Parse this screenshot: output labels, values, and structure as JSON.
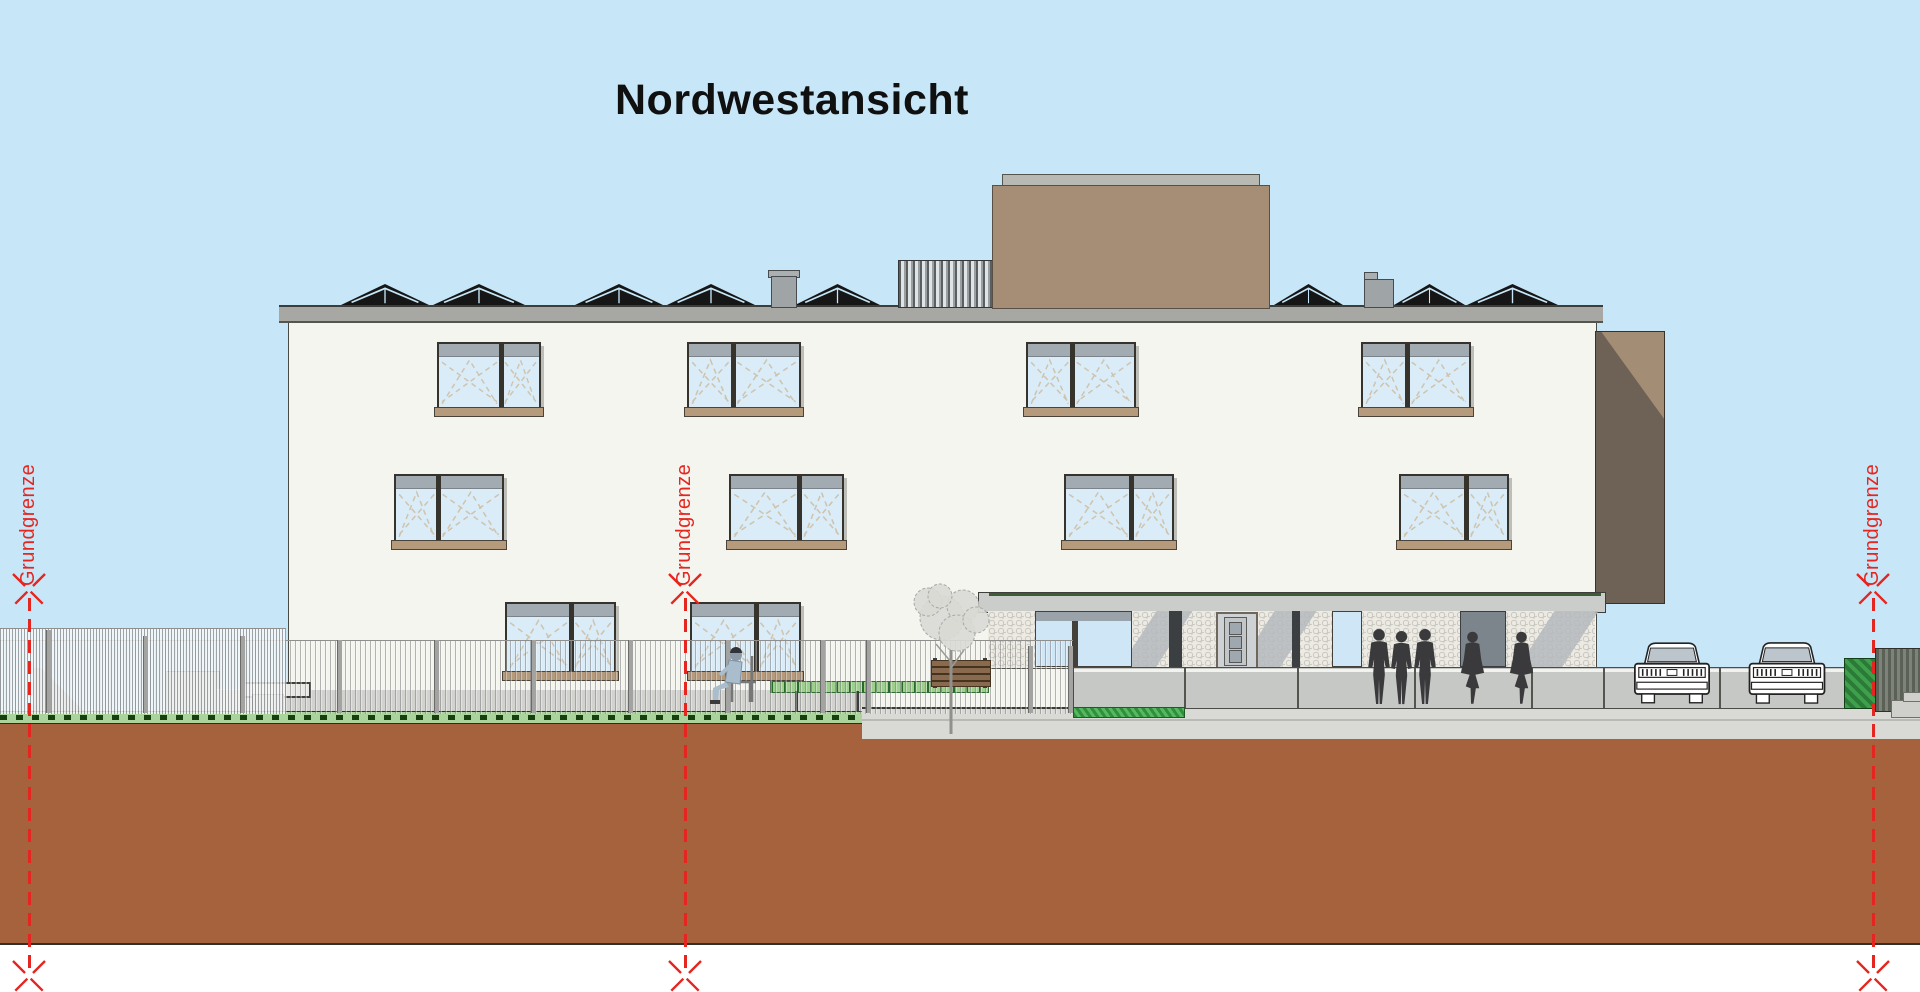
{
  "title": "Nordwestansicht",
  "boundary_labels": [
    "Grundgrenze",
    "Grundgrenze",
    "Grundgrenze"
  ],
  "colors": {
    "sky": "#c7e7f8",
    "facade": "#f5f5ef",
    "roof_band": "#a7a7a3",
    "solar_panel": "#161616",
    "penthouse_brown": "#a68d76",
    "wing_dark": "#6e6156",
    "wing_light": "#a48d75",
    "window_glass": "#d9ecf8",
    "window_sill": "#b59a7c",
    "canopy": "#cbcdca",
    "parapet": "#c6c8c5",
    "grass": "#abd49c",
    "hatch_green": "#3fa04c",
    "ground_earth": "#a6623c",
    "boundary_red": "#e52620",
    "silhouette": "#3a3a3c"
  }
}
